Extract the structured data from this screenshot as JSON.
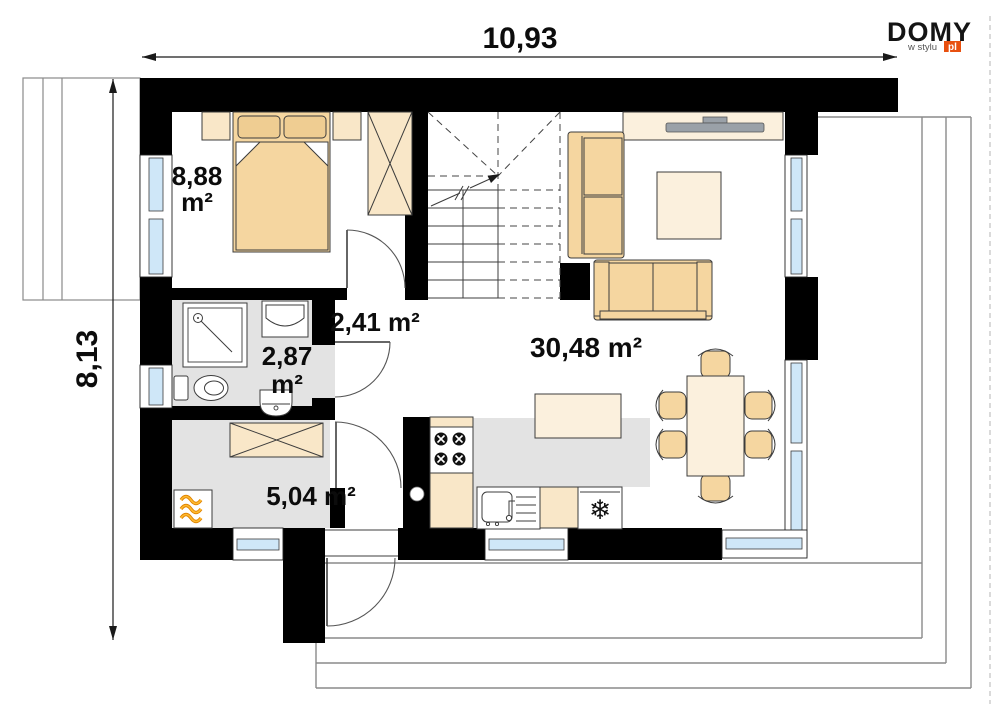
{
  "logo": {
    "brand": "DOMY",
    "tagline": "w stylu",
    "suffix": "pl"
  },
  "dimensions": {
    "width_label": "10,93",
    "height_label": "8,13"
  },
  "rooms": {
    "bedroom": {
      "area": "8,88",
      "unit": "m²"
    },
    "hallway": {
      "area": "2,41 m²"
    },
    "bathroom": {
      "area": "2,87",
      "unit": "m²"
    },
    "utility": {
      "area": "5,04 m²"
    },
    "living": {
      "area": "30,48 m²"
    }
  },
  "icons": {
    "fridge_snowflake": "❄"
  },
  "colors": {
    "wall": "#000000",
    "tan": "#f5d6a0",
    "tan_deep": "#efcd92",
    "cream": "#f9e7c8",
    "pale": "#fbf0dd",
    "floor_gray": "#e3e3e3",
    "glass_blue": "#cfe7f8",
    "tv_gray": "#9aa1a8",
    "logo_orange": "#e8500f",
    "flame_orange": "#e08400",
    "flame_yellow": "#ffba30",
    "line": "#3c3c3c"
  }
}
